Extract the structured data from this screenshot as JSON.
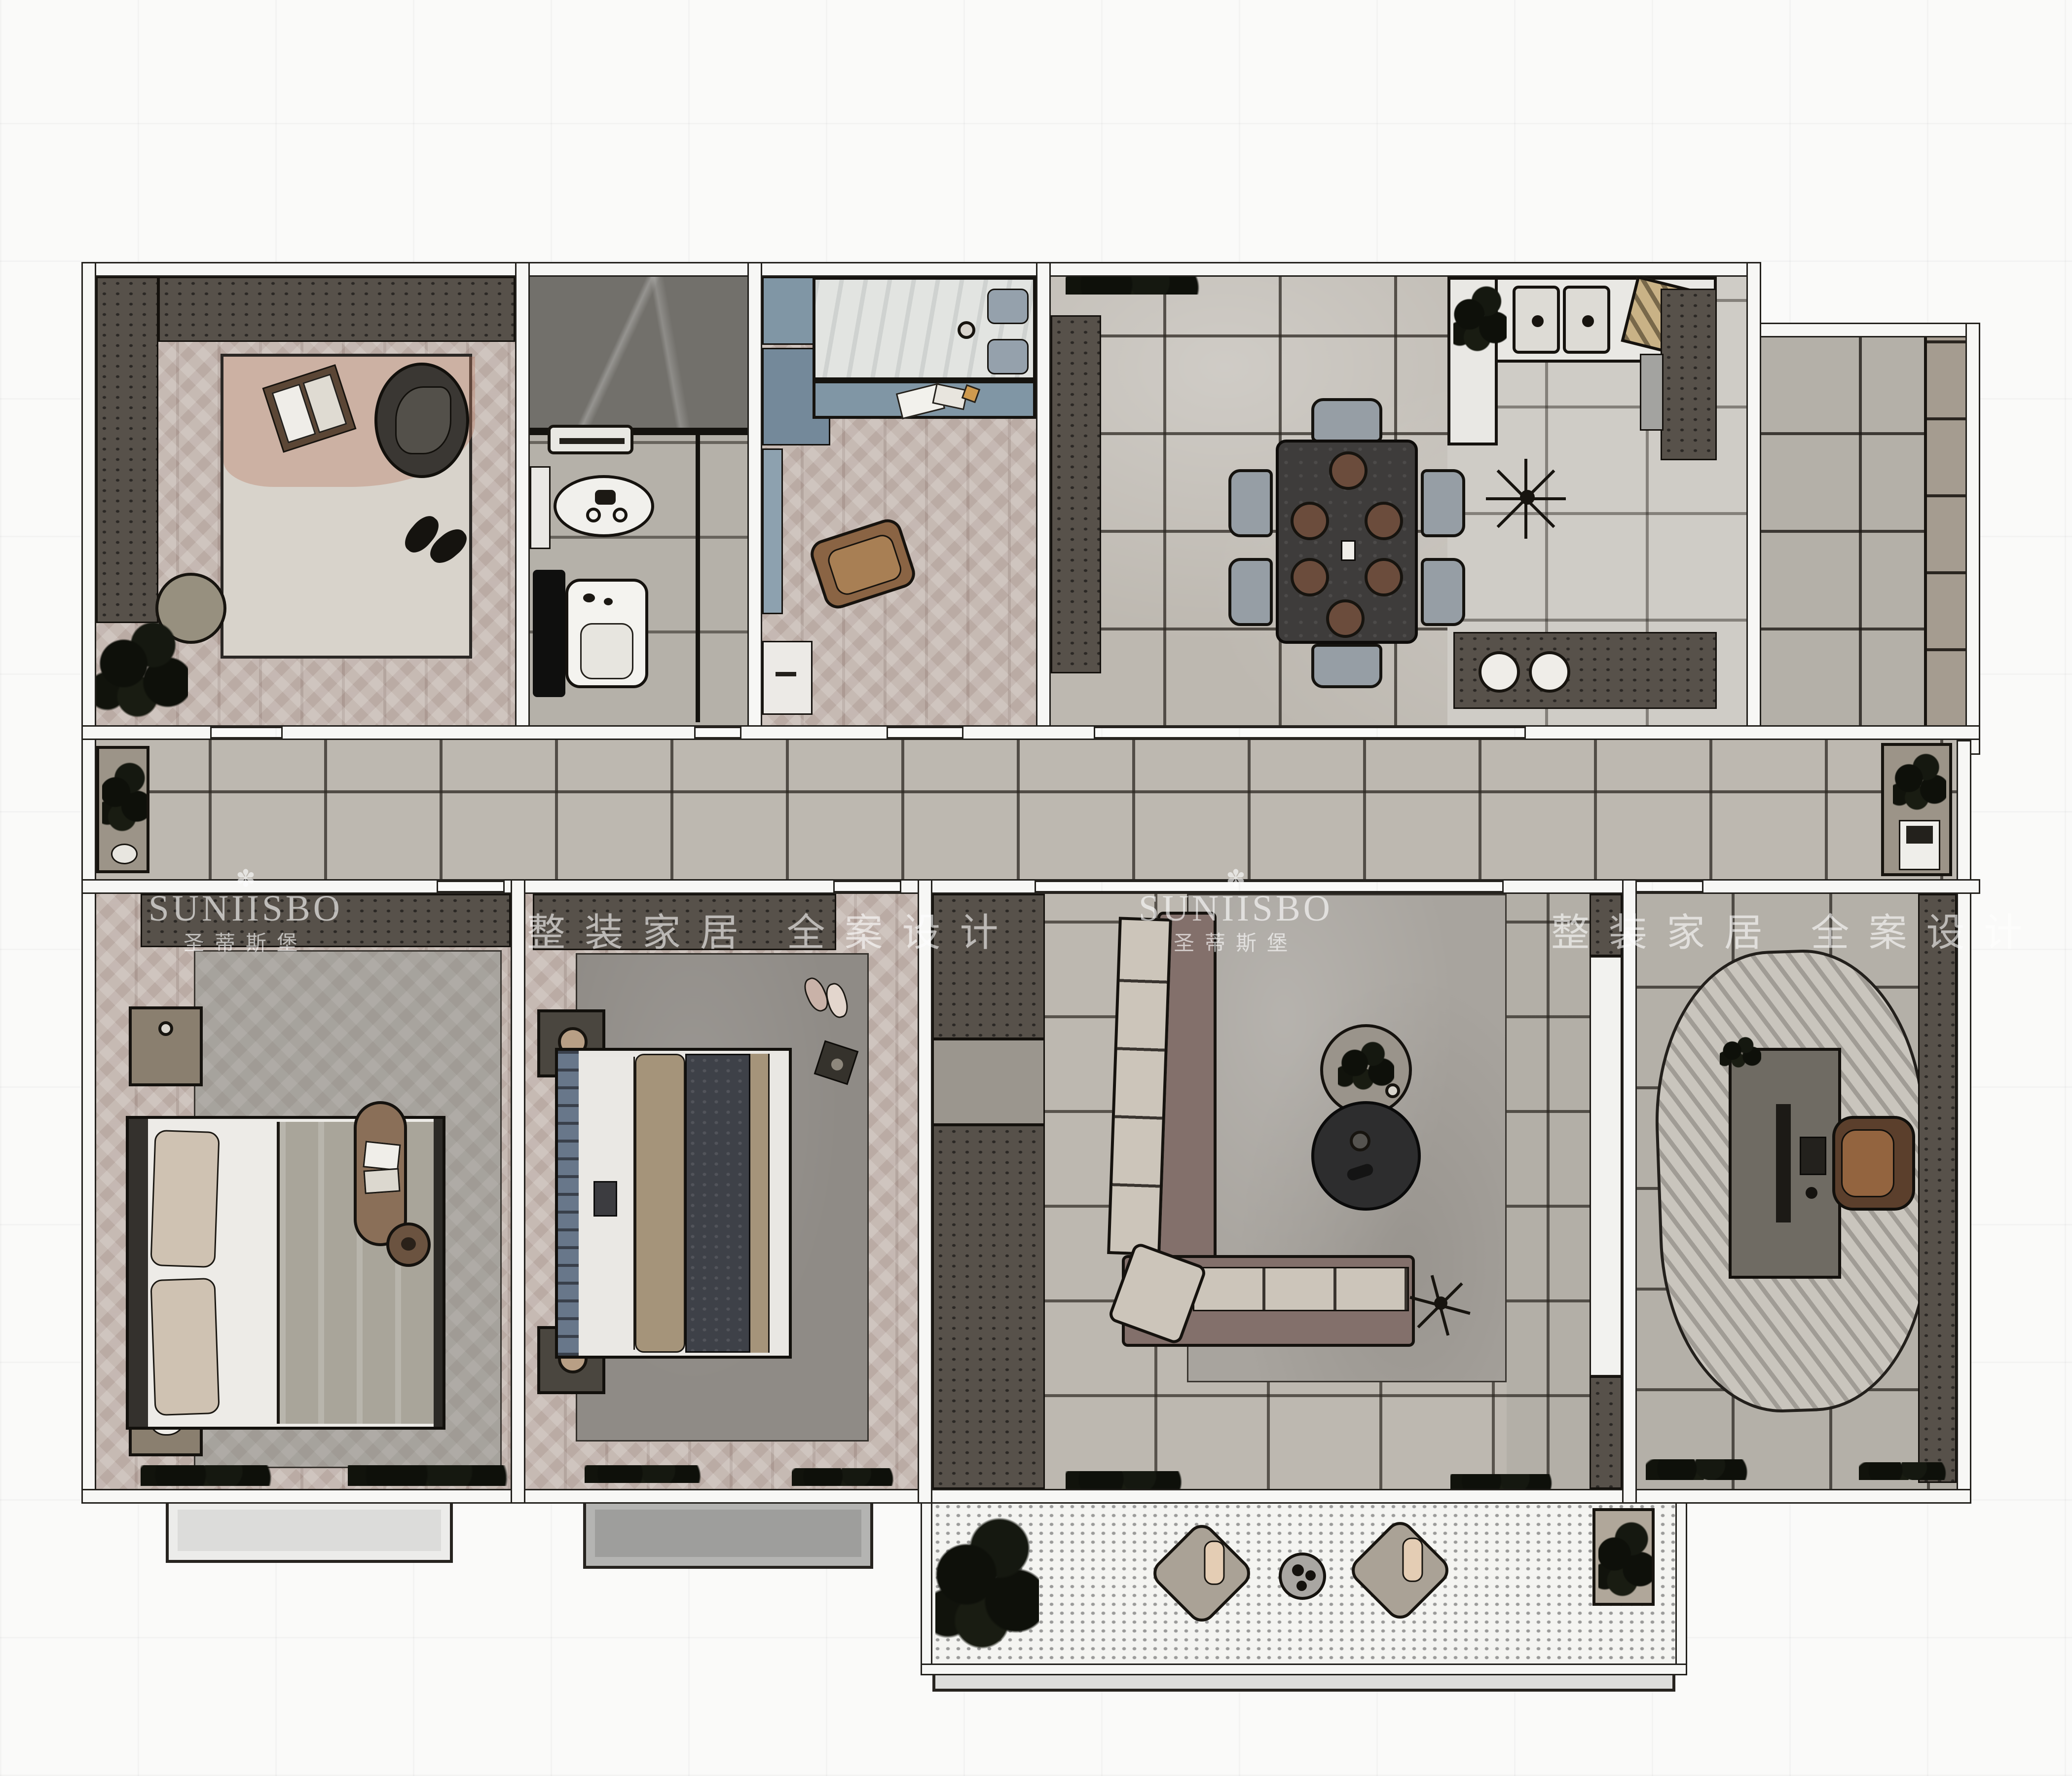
{
  "watermark": {
    "logo_glyph": "✽",
    "brand": "SUNIISBO",
    "brand_cn": "圣蒂斯堡",
    "slogan": "整装家居 全案设计"
  },
  "palette": {
    "background": "#fafaf9",
    "wall_fill": "#f7f7f5",
    "wall_line": "#22201c",
    "tile_floor": "#bdb8b0",
    "herringbone": "#c6bab3",
    "cabinet_dark": "#57514a",
    "cabinet_blue": "#8096a5",
    "kitchen_white": "#e9e8e4",
    "sofa_frame": "#83706b",
    "cushion_light": "#ccc5ba",
    "rug_light": "#d8d3cb",
    "rug_gray": "#a8a49e",
    "rug_dark": "#8f8b86",
    "wood_brown": "#8a6f58",
    "table_dark": "#2d2d2e",
    "chair_gray": "#969ea5",
    "shower_marble": "#72706b",
    "watermark": "#ffffff"
  }
}
